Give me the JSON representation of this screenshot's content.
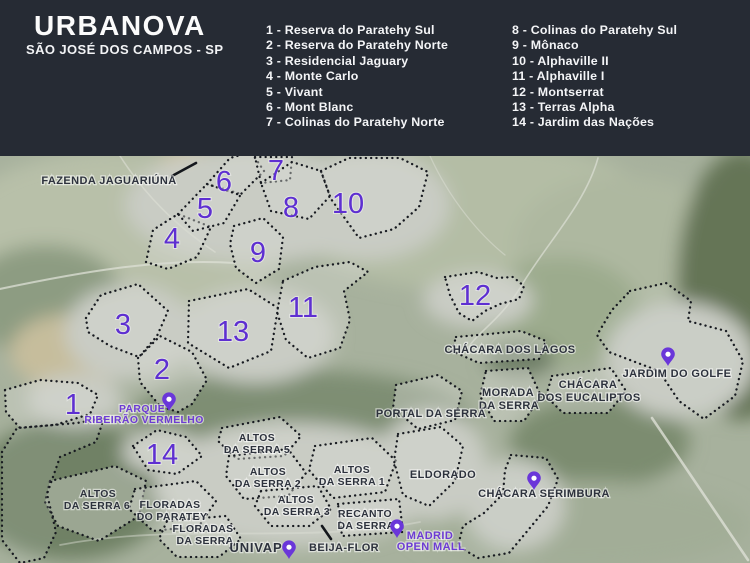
{
  "header": {
    "title": "URBANOVA",
    "subtitle": "SÃO JOSÉ DOS CAMPOS - SP",
    "legend_col1": [
      "1 - Reserva do Paratehy Sul",
      "2 - Reserva do Paratehy Norte",
      "3 - Residencial Jaguary",
      "4 - Monte Carlo",
      "5 - Vivant",
      "6 - Mont Blanc",
      "7 - Colinas do Paratehy Norte"
    ],
    "legend_col2": [
      "8 - Colinas do Paratehy Sul",
      "9 - Mônaco",
      "10 - Alphaville II",
      "11 - Alphaville I",
      "12 - Montserrat",
      "13 - Terras Alpha",
      "14 - Jardim das Nações"
    ]
  },
  "map": {
    "numbers": [
      "1",
      "2",
      "3",
      "4",
      "5",
      "6",
      "7",
      "8",
      "9",
      "10",
      "11",
      "12",
      "13",
      "14"
    ],
    "labels": {
      "fazenda": {
        "l1": "FAZENDA JAGUARIÚNA"
      },
      "lagos": {
        "l1": "CHÁCARA DOS LAGOS"
      },
      "morada": {
        "l1": "MORADA",
        "l2": "DA SERRA"
      },
      "eucaliptos": {
        "l1": "CHÁCARA",
        "l2": "DOS EUCALIPTOS"
      },
      "portal": {
        "l1": "PORTAL DA SERRA"
      },
      "golfe": {
        "l1": "JARDIM DO GOLFE"
      },
      "eldorado": {
        "l1": "ELDORADO"
      },
      "serimbura": {
        "l1": "CHÁCARA SERIMBURA"
      },
      "altos5": {
        "l1": "ALTOS",
        "l2": "DA SERRA 5"
      },
      "altos2": {
        "l1": "ALTOS",
        "l2": "DA SERRA 2"
      },
      "altos1": {
        "l1": "ALTOS",
        "l2": "DA SERRA 1"
      },
      "altos3": {
        "l1": "ALTOS",
        "l2": "DA SERRA 3"
      },
      "altos6": {
        "l1": "ALTOS",
        "l2": "DA SERRA 6"
      },
      "floradas_paratey": {
        "l1": "FLORADAS",
        "l2": "DO PARATEY"
      },
      "floradas_serra": {
        "l1": "FLORADAS",
        "l2": "DA SERRA"
      },
      "recanto": {
        "l1": "RECANTO",
        "l2": "DA SERRA"
      },
      "univap": {
        "l1": "UNIVAP"
      },
      "beija_flor": {
        "l1": "BEIJA-FLOR"
      }
    },
    "purple_labels": {
      "parque": {
        "l1": "PARQUE",
        "l2": "RIBEIRÃO VERMELHO"
      },
      "madrid": {
        "l1": "MADRID",
        "l2": "OPEN MALL"
      }
    },
    "icons": {
      "location_pin": "map-marker"
    }
  },
  "colors": {
    "header_bg": "#262b34",
    "accent_purple": "#5e2fd1",
    "pin_purple": "#6a36d9",
    "purple_label": "#6d3bd4",
    "dark_label": "#2d323d",
    "outline_dots": "#171a20"
  }
}
